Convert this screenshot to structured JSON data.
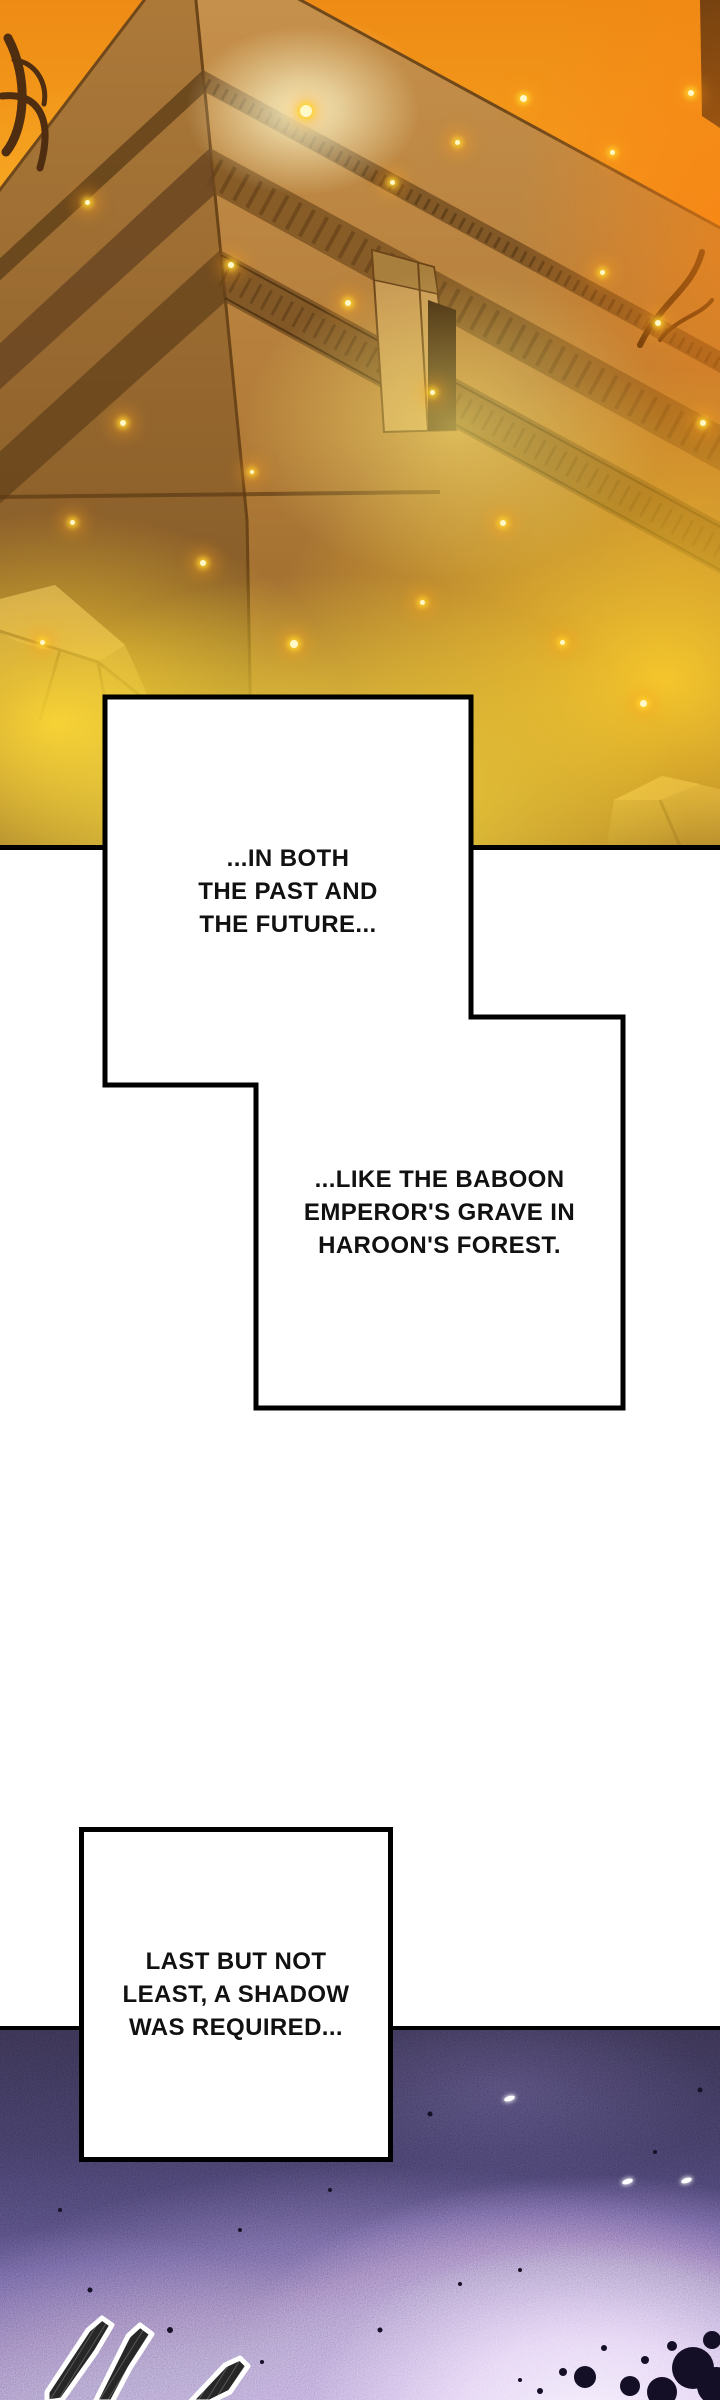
{
  "captions": [
    {
      "lines": [
        "...IN BOTH",
        "THE PAST AND",
        "THE FUTURE..."
      ]
    },
    {
      "lines": [
        "...LIKE THE BABOON",
        "EMPEROR'S GRAVE IN",
        "HAROON'S FOREST."
      ]
    },
    {
      "lines": [
        "LAST BUT NOT",
        "LEAST, A SHADOW",
        "WAS REQUIRED..."
      ]
    }
  ],
  "panels": [
    {
      "scene": "Ancient stone pyramid temple engulfed in roaring yellow-orange flames, with burning trees and rocks at its base"
    },
    {
      "scene": "Dark violet night scene with a purple glow, ink-black blobs and jagged outlined shards"
    }
  ],
  "palette": {
    "fire_yellow": "#ffdf3f",
    "fire_orange": "#f59f1c",
    "pyramid_tan": "#c08b44",
    "night_dark": "#1c1634",
    "night_glow": "#e9dcf7",
    "ink": "#000000",
    "paper": "#ffffff"
  }
}
